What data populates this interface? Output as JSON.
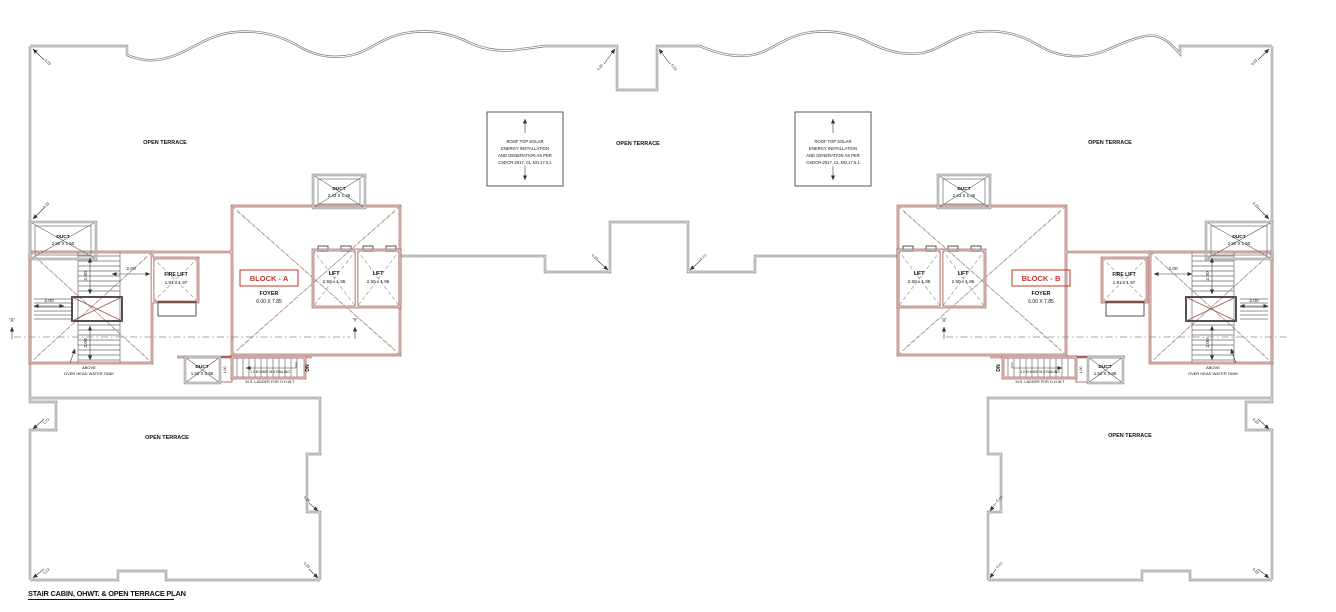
{
  "title": "STAIR CABIN, OHWT. & OPEN TERRACE PLAN",
  "terrace_label": "OPEN TERRACE",
  "solar_note": {
    "line1": "ROOF TOP SOLAR",
    "line2": "ENERGY INSTALLATION",
    "line3": "AND GENERATION AS PER",
    "line4": "CSDCR-2017, CL.NO.17.5.1"
  },
  "block_a": {
    "name": "BLOCK - A"
  },
  "block_b": {
    "name": "BLOCK - B"
  },
  "foyer": {
    "label": "FOYER",
    "size": "6.00 X 7.85"
  },
  "lift": {
    "label": "LIFT",
    "size": "2.50 x 1.95"
  },
  "fire_lift": {
    "label": "FIRE LIFT",
    "size": "1.91 x 1.97"
  },
  "duct_top": {
    "label": "DUCT",
    "size": "2.43 X 1.45"
  },
  "duct_side": {
    "label": "DUCT",
    "size": "2.50 X 1.50"
  },
  "duct_bottom": {
    "label": "DUCT",
    "size": "1.52 X 0.95"
  },
  "ohwt_note": {
    "line1": "ABOVE",
    "line2": "OVER HEAD WATER TANK"
  },
  "ladder": {
    "inner_note": "1.0 M WIDE M.S RAILING",
    "note": "M.S. LADDER FOR O.H.W.T",
    "dn": "DN",
    "strip": "1.00"
  },
  "dims": {
    "two": "2.00",
    "wall": "0.23"
  },
  "markers": {
    "x": "'X'",
    "y": "'Y'"
  }
}
